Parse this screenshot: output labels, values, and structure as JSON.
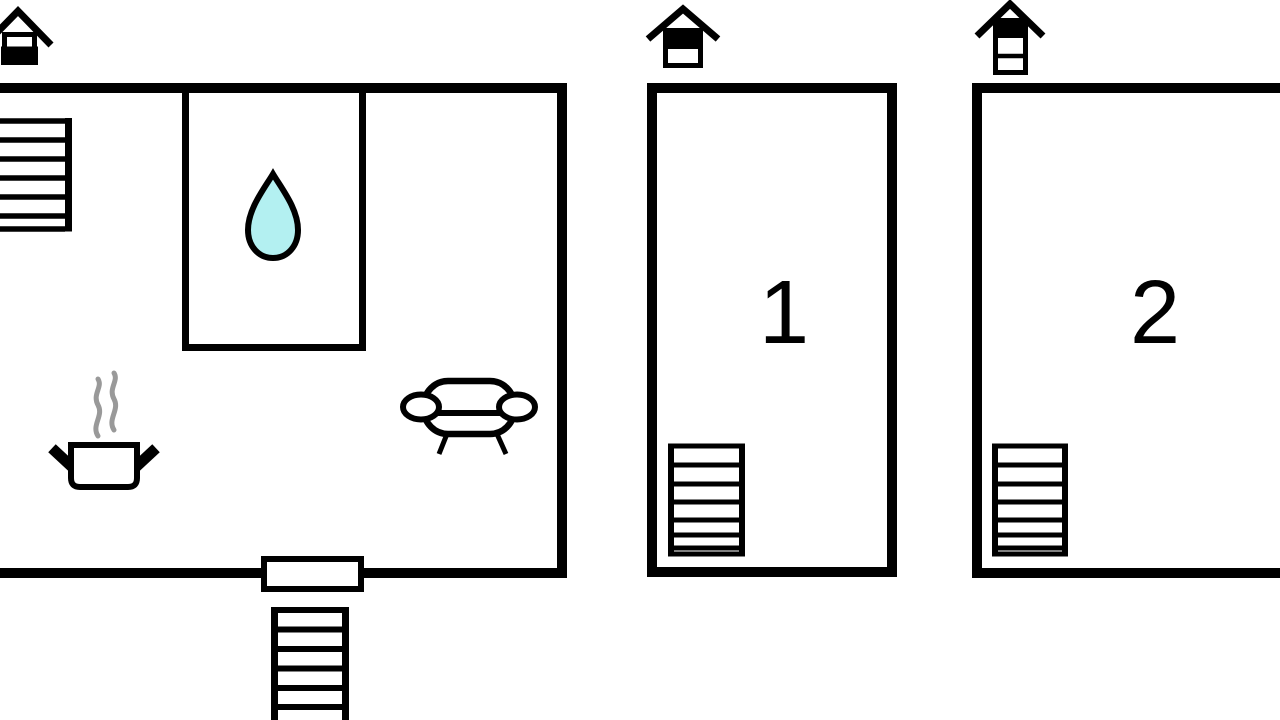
{
  "floorplan": {
    "colors": {
      "background": "#ffffff",
      "ink": "#000000",
      "water_drop_fill": "#b3f0f1",
      "steam": "#999999"
    },
    "units": [
      {
        "name": "main-unit",
        "label": ""
      },
      {
        "name": "unit-1",
        "label": "1"
      },
      {
        "name": "unit-2",
        "label": "2"
      }
    ],
    "icons": [
      "floor-indicator-main-icon",
      "floor-indicator-unit1-icon",
      "floor-indicator-unit2-icon",
      "interior-staircase-icon",
      "water-drop-icon",
      "kitchen-pot-steam-icon",
      "sofa-icon",
      "entrance-door",
      "exterior-staircase-icon",
      "unit1-staircase-icon",
      "unit2-staircase-icon"
    ]
  }
}
